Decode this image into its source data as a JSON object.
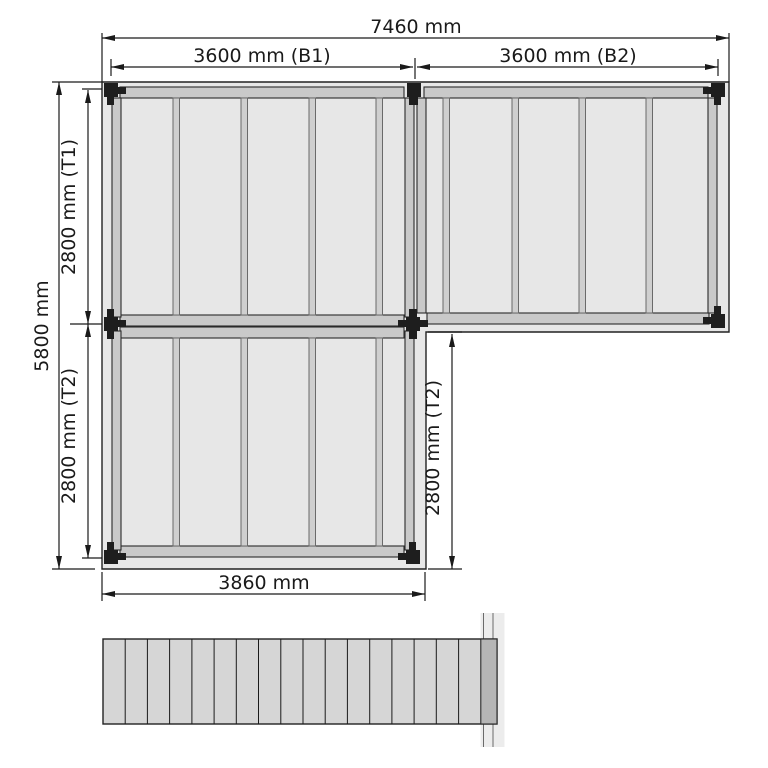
{
  "plan": {
    "dims": {
      "total_width": "7460 mm",
      "bay_b1": "3600 mm (B1)",
      "bay_b2": "3600 mm (B2)",
      "total_depth": "5800 mm",
      "t1": "2800 mm (T1)",
      "t2_left": "2800 mm (T2)",
      "t2_right": "2800 mm (T2)",
      "bottom_width": "3860 mm"
    },
    "structure": {
      "bays": [
        "B1",
        "B2"
      ],
      "fields": [
        "T1",
        "T2"
      ],
      "post_count": 8,
      "joists_per_bay": 6,
      "deck_board_count": 18
    },
    "colors": {
      "background": "#ffffff",
      "deck_fill": "#e7e7e7",
      "beam_fill": "#c9c9c9",
      "joist_fill": "#cfcfcf",
      "post_fill": "#1e1e1e",
      "line": "#1a1a1a",
      "board_fill": "#d6d6d6",
      "board_dark_fill": "#b5b5b5",
      "band_fill": "#ececec"
    }
  }
}
